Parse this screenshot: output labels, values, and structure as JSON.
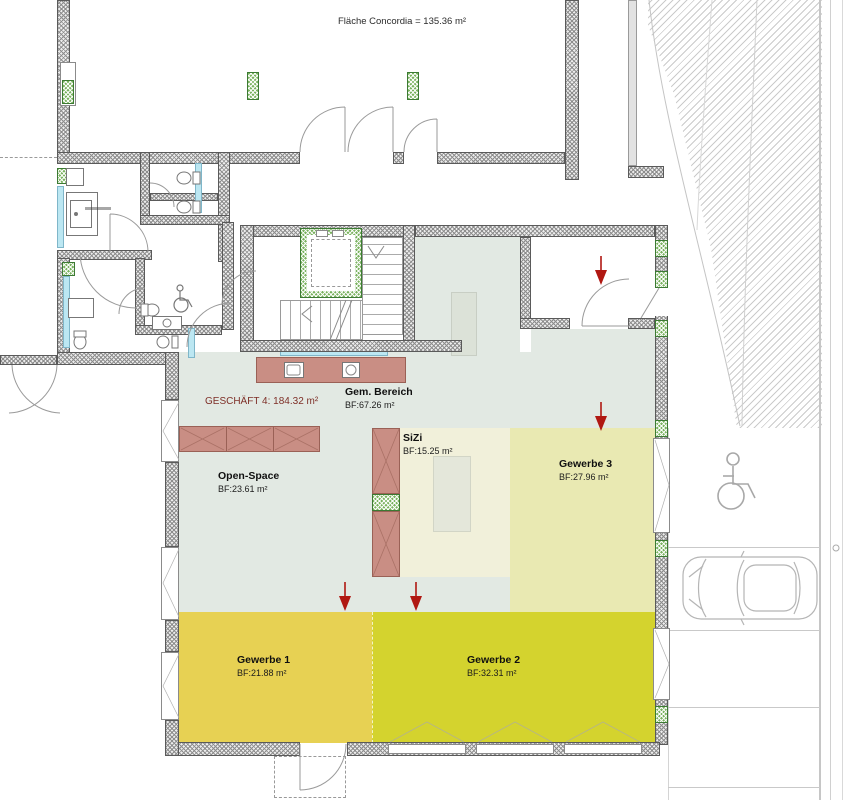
{
  "plan": {
    "concordia_label": "Fläche Concordia = 135.36 m²",
    "geschaeft_label": "GESCHÄFT 4: 184.32 m²",
    "rooms": {
      "gem_bereich": {
        "name": "Gem. Bereich",
        "area": "BF:67.26 m²"
      },
      "open_space": {
        "name": "Open-Space",
        "area": "BF:23.61 m²"
      },
      "sizi": {
        "name": "SiZi",
        "area": "BF:15.25 m²"
      },
      "gewerbe3": {
        "name": "Gewerbe 3",
        "area": "BF:27.96 m²"
      },
      "gewerbe1": {
        "name": "Gewerbe 1",
        "area": "BF:21.88 m²"
      },
      "gewerbe2": {
        "name": "Gewerbe 2",
        "area": "BF:32.31 m²"
      }
    },
    "colors": {
      "gem_bereich_fill": "#e2e9e3",
      "sizi_fill": "#f1f0da",
      "gewerbe1_fill": "#e7d153",
      "gewerbe2_fill": "#d4d32e",
      "gewerbe3_fill": "#e9e9b2",
      "furniture_fill": "#c98e84",
      "glass_fill": "#bce7f2",
      "column_green": "#79b25e",
      "entry_arrow_red": "#b01812",
      "geschaeft_text": "#7e2f27"
    }
  }
}
